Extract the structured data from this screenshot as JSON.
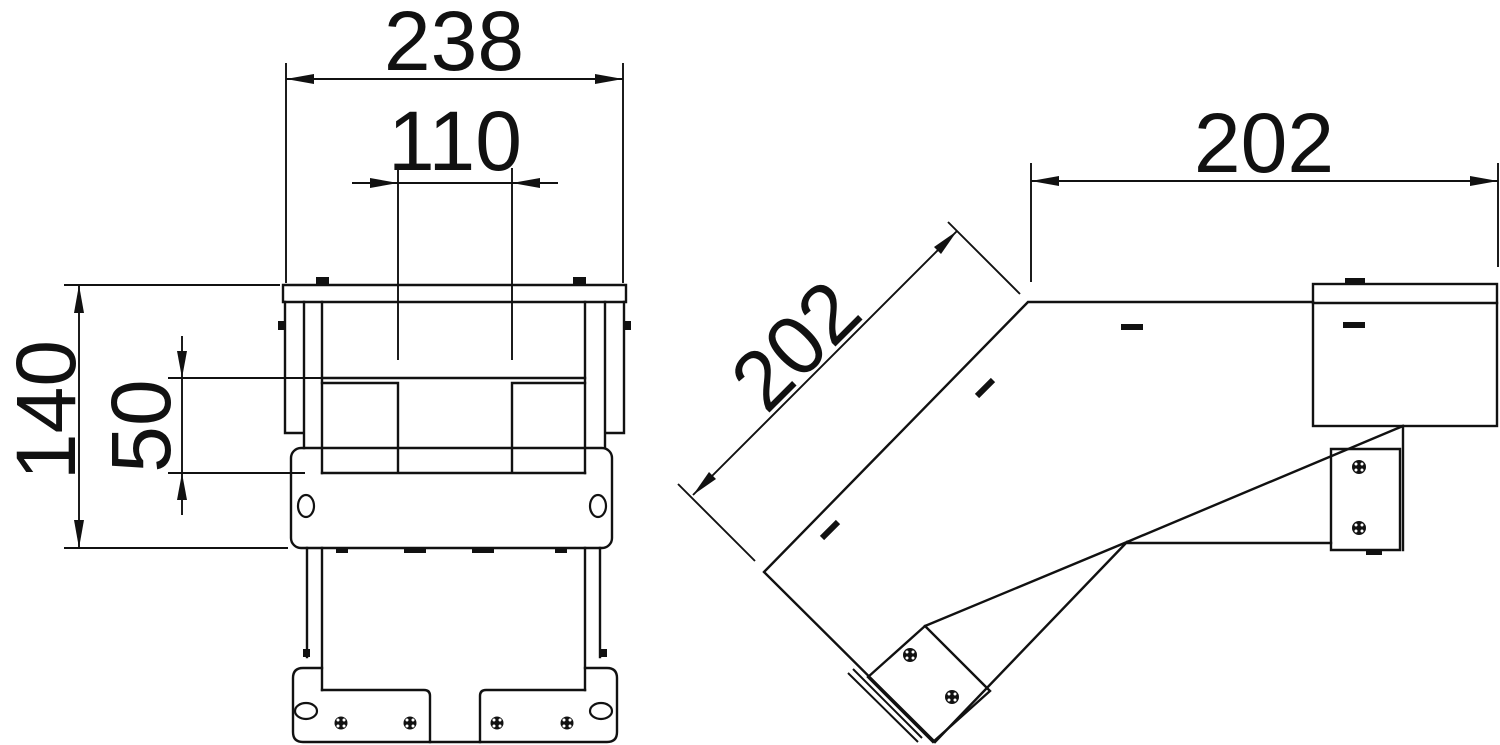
{
  "drawing": {
    "kind": "technical-dimension-drawing",
    "views": {
      "front_view": {
        "name": "front view",
        "dim_overall_width": "238",
        "dim_inner_width": "110",
        "dim_overall_height": "140",
        "dim_inner_height": "50"
      },
      "side_view": {
        "name": "side view 45-degree bend",
        "dim_horizontal_length": "202",
        "dim_diagonal_length": "202"
      }
    },
    "line_color": "#111111",
    "background_color": "#ffffff"
  }
}
